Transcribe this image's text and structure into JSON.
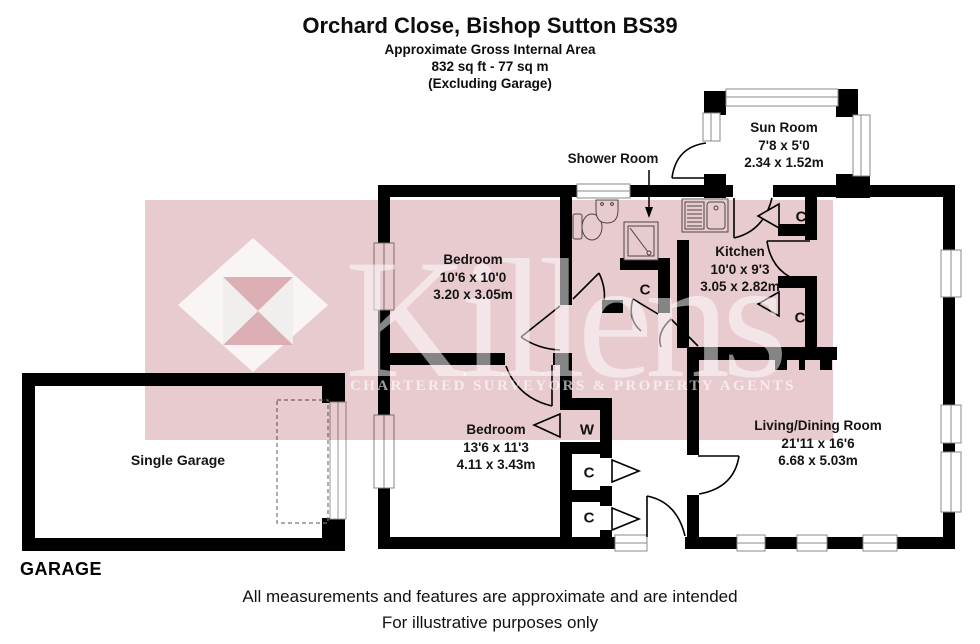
{
  "header": {
    "title": "Orchard Close, Bishop Sutton BS39",
    "area_label": "Approximate Gross Internal Area",
    "area_value": "832 sq ft - 77 sq m",
    "area_note": "(Excluding Garage)"
  },
  "watermark": {
    "brand": "Killens",
    "tagline": "CHARTERED SURVEYORS & PROPERTY AGENTS",
    "band_color": "#e8cbcf"
  },
  "rooms": {
    "bedroom1": {
      "name": "Bedroom",
      "imperial": "10'6 x 10'0",
      "metric": "3.20 x 3.05m"
    },
    "bedroom2": {
      "name": "Bedroom",
      "imperial": "13'6 x 11'3",
      "metric": "4.11 x 3.43m"
    },
    "kitchen": {
      "name": "Kitchen",
      "imperial": "10'0 x 9'3",
      "metric": "3.05 x 2.82m"
    },
    "sun_room": {
      "name": "Sun Room",
      "imperial": "7'8 x 5'0",
      "metric": "2.34 x 1.52m"
    },
    "living_dining": {
      "name": "Living/Dining Room",
      "imperial": "21'11 x 16'6",
      "metric": "6.68 x 5.03m"
    },
    "shower_room": {
      "name": "Shower Room"
    },
    "garage": {
      "name": "Single Garage"
    }
  },
  "labels": {
    "garage_caption": "GARAGE",
    "cupboard": "C",
    "wardrobe": "W"
  },
  "footer": {
    "line1": "All measurements and features are approximate and are intended",
    "line2": "For illustrative purposes only"
  }
}
